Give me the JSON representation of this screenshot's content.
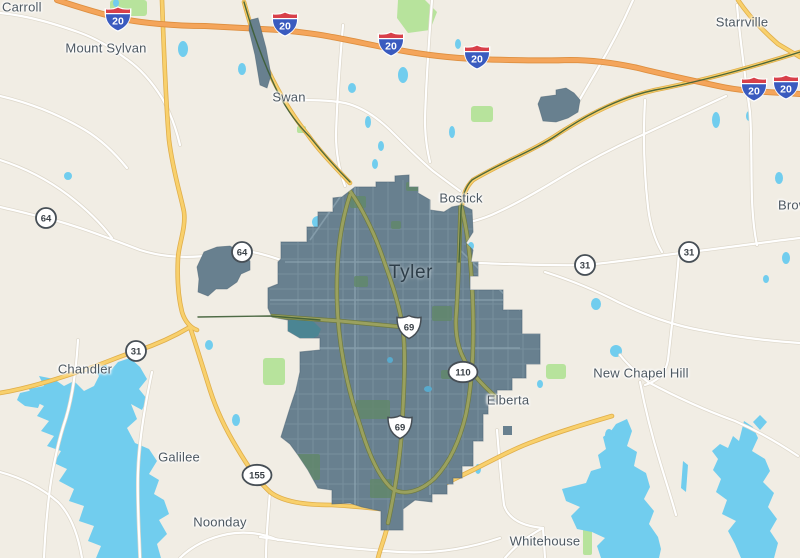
{
  "city": {
    "label": "Tyler"
  },
  "places": [
    {
      "name": "Carroll"
    },
    {
      "name": "Mount Sylvan"
    },
    {
      "name": "Swan"
    },
    {
      "name": "Starrville"
    },
    {
      "name": "Bostick"
    },
    {
      "name": "Brown"
    },
    {
      "name": "Chandler"
    },
    {
      "name": "New Chapel Hill"
    },
    {
      "name": "Elberta"
    },
    {
      "name": "Galilee"
    },
    {
      "name": "Noonday"
    },
    {
      "name": "Whitehouse"
    }
  ],
  "shields": {
    "interstate": [
      {
        "label": "20"
      },
      {
        "label": "20"
      },
      {
        "label": "20"
      },
      {
        "label": "20"
      },
      {
        "label": "20"
      },
      {
        "label": "20"
      }
    ],
    "us_route": [
      {
        "label": "69"
      },
      {
        "label": "69"
      }
    ],
    "state_circle": [
      {
        "label": "64"
      },
      {
        "label": "64"
      },
      {
        "label": "31"
      },
      {
        "label": "31"
      },
      {
        "label": "31"
      }
    ],
    "state_oval": [
      {
        "label": "110"
      },
      {
        "label": "155"
      }
    ]
  },
  "colors": {
    "background": "#f1ede4",
    "city_fill": "#68808f",
    "city_street": "#849cab",
    "water": "#71cdee",
    "city_lake": "#4b8593",
    "park_green": "#b7e39c",
    "city_park": "#62886c",
    "road_white": "#ffffff",
    "road_yellow": "#f8d06c",
    "road_olive": "#9aa15f",
    "interstate_orange": "#f4a55b",
    "rail_green": "#3c5c33",
    "shield_blue": "#3a5bbf",
    "shield_red": "#d8404a",
    "label_text": "#4d5861"
  }
}
